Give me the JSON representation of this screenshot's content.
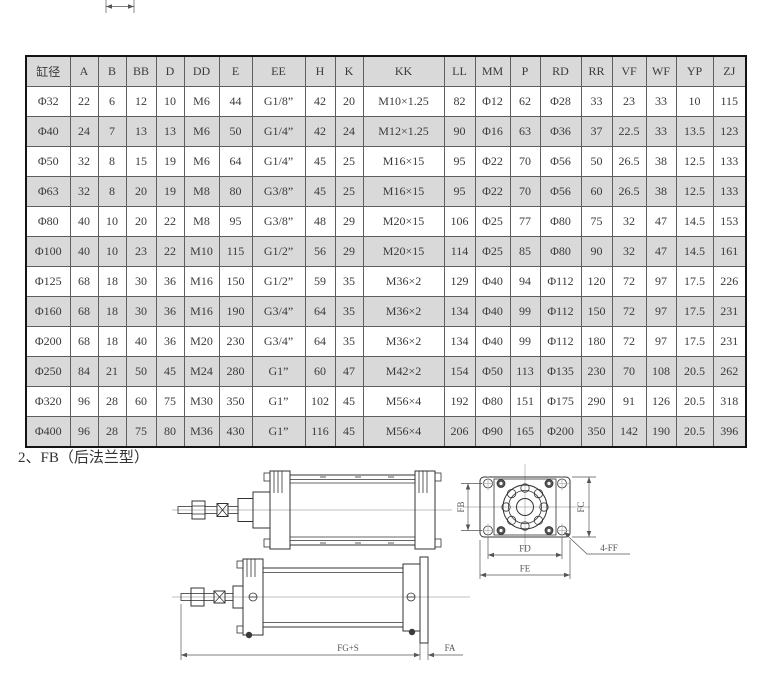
{
  "section_title": "2、FB（后法兰型）",
  "table": {
    "headers": [
      "缸径",
      "A",
      "B",
      "BB",
      "D",
      "DD",
      "E",
      "EE",
      "H",
      "K",
      "KK",
      "LL",
      "MM",
      "P",
      "RD",
      "RR",
      "VF",
      "WF",
      "YP",
      "ZJ"
    ],
    "rows": [
      [
        "Φ32",
        "22",
        "6",
        "12",
        "10",
        "M6",
        "44",
        "G1/8”",
        "42",
        "20",
        "M10×1.25",
        "82",
        "Φ12",
        "62",
        "Φ28",
        "33",
        "23",
        "33",
        "10",
        "115"
      ],
      [
        "Φ40",
        "24",
        "7",
        "13",
        "13",
        "M6",
        "50",
        "G1/4”",
        "42",
        "24",
        "M12×1.25",
        "90",
        "Φ16",
        "63",
        "Φ36",
        "37",
        "22.5",
        "33",
        "13.5",
        "123"
      ],
      [
        "Φ50",
        "32",
        "8",
        "15",
        "19",
        "M6",
        "64",
        "G1/4”",
        "45",
        "25",
        "M16×15",
        "95",
        "Φ22",
        "70",
        "Φ56",
        "50",
        "26.5",
        "38",
        "12.5",
        "133"
      ],
      [
        "Φ63",
        "32",
        "8",
        "20",
        "19",
        "M8",
        "80",
        "G3/8”",
        "45",
        "25",
        "M16×15",
        "95",
        "Φ22",
        "70",
        "Φ56",
        "60",
        "26.5",
        "38",
        "12.5",
        "133"
      ],
      [
        "Φ80",
        "40",
        "10",
        "20",
        "22",
        "M8",
        "95",
        "G3/8”",
        "48",
        "29",
        "M20×15",
        "106",
        "Φ25",
        "77",
        "Φ80",
        "75",
        "32",
        "47",
        "14.5",
        "153"
      ],
      [
        "Φ100",
        "40",
        "10",
        "23",
        "22",
        "M10",
        "115",
        "G1/2”",
        "56",
        "29",
        "M20×15",
        "114",
        "Φ25",
        "85",
        "Φ80",
        "90",
        "32",
        "47",
        "14.5",
        "161"
      ],
      [
        "Φ125",
        "68",
        "18",
        "30",
        "36",
        "M16",
        "150",
        "G1/2”",
        "59",
        "35",
        "M36×2",
        "129",
        "Φ40",
        "94",
        "Φ112",
        "120",
        "72",
        "97",
        "17.5",
        "226"
      ],
      [
        "Φ160",
        "68",
        "18",
        "30",
        "36",
        "M16",
        "190",
        "G3/4”",
        "64",
        "35",
        "M36×2",
        "134",
        "Φ40",
        "99",
        "Φ112",
        "150",
        "72",
        "97",
        "17.5",
        "231"
      ],
      [
        "Φ200",
        "68",
        "18",
        "40",
        "36",
        "M20",
        "230",
        "G3/4”",
        "64",
        "35",
        "M36×2",
        "134",
        "Φ40",
        "99",
        "Φ112",
        "180",
        "72",
        "97",
        "17.5",
        "231"
      ],
      [
        "Φ250",
        "84",
        "21",
        "50",
        "45",
        "M24",
        "280",
        "G1”",
        "60",
        "47",
        "M42×2",
        "154",
        "Φ50",
        "113",
        "Φ135",
        "230",
        "70",
        "108",
        "20.5",
        "262"
      ],
      [
        "Φ320",
        "96",
        "28",
        "60",
        "75",
        "M30",
        "350",
        "G1”",
        "102",
        "45",
        "M56×4",
        "192",
        "Φ80",
        "151",
        "Φ175",
        "290",
        "91",
        "126",
        "20.5",
        "318"
      ],
      [
        "Φ400",
        "96",
        "28",
        "75",
        "80",
        "M36",
        "430",
        "G1”",
        "116",
        "45",
        "M56×4",
        "206",
        "Φ90",
        "165",
        "Φ200",
        "350",
        "142",
        "190",
        "20.5",
        "396"
      ]
    ]
  },
  "drawings": {
    "fb": "FB",
    "fc": "FC",
    "fd": "FD",
    "fe": "FE",
    "ff": "4-FF",
    "fg": "FG+S",
    "fa": "FA"
  },
  "colors": {
    "row_alt": "#d9d9d9",
    "grid_line": "#5f5f5f",
    "outer_border": "#141414",
    "text": "#3a3a3a",
    "drawing_line": "#333333",
    "centerline": "#aaaaaa"
  }
}
